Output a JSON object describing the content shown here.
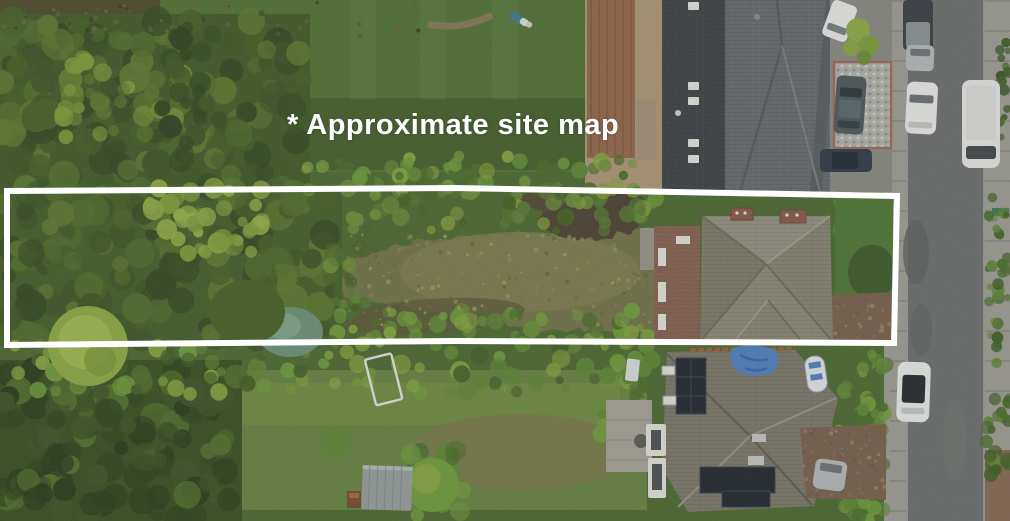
{
  "annotation": {
    "label": "* Approximate site map",
    "color": "#ffffff",
    "font_px": 29
  },
  "boundary": {
    "color": "#ffffff",
    "stroke_px": 6,
    "shape": "rectangle"
  },
  "palette": {
    "forest_dark": "#3a5524",
    "forest_mid": "#4e7029",
    "forest_light": "#8fae43",
    "lawn": "#507433",
    "lawn_dark": "#3e5e28",
    "meadow": "#73754a",
    "bush_bright": "#6f9f3a",
    "road_asphalt": "#6e706f",
    "sidewalk": "#a0a099",
    "roof_dark": "#3d4145",
    "roof_gray": "#666b6e",
    "roof_site": "#8e8c7f",
    "roof_bottom": "#7d786b",
    "brick": "#87624f",
    "driveway": "#7b614c",
    "cobble": "#b5b5ae",
    "tarp_blue": "#4e83c6",
    "solar_panel": "#1f252d",
    "car_white": "#eff0ee",
    "car_silver": "#b9bdbd",
    "car_dark": "#383e43",
    "patio_tan": "#b29878",
    "rust_roof": "#95674a"
  },
  "scene": {
    "objects": [
      "woodland",
      "overgrown-site-strip",
      "site-house",
      "upper-neighbour-house",
      "lower-neighbour-house",
      "road",
      "parked-cars",
      "gardens",
      "shed",
      "goal-posts"
    ]
  }
}
